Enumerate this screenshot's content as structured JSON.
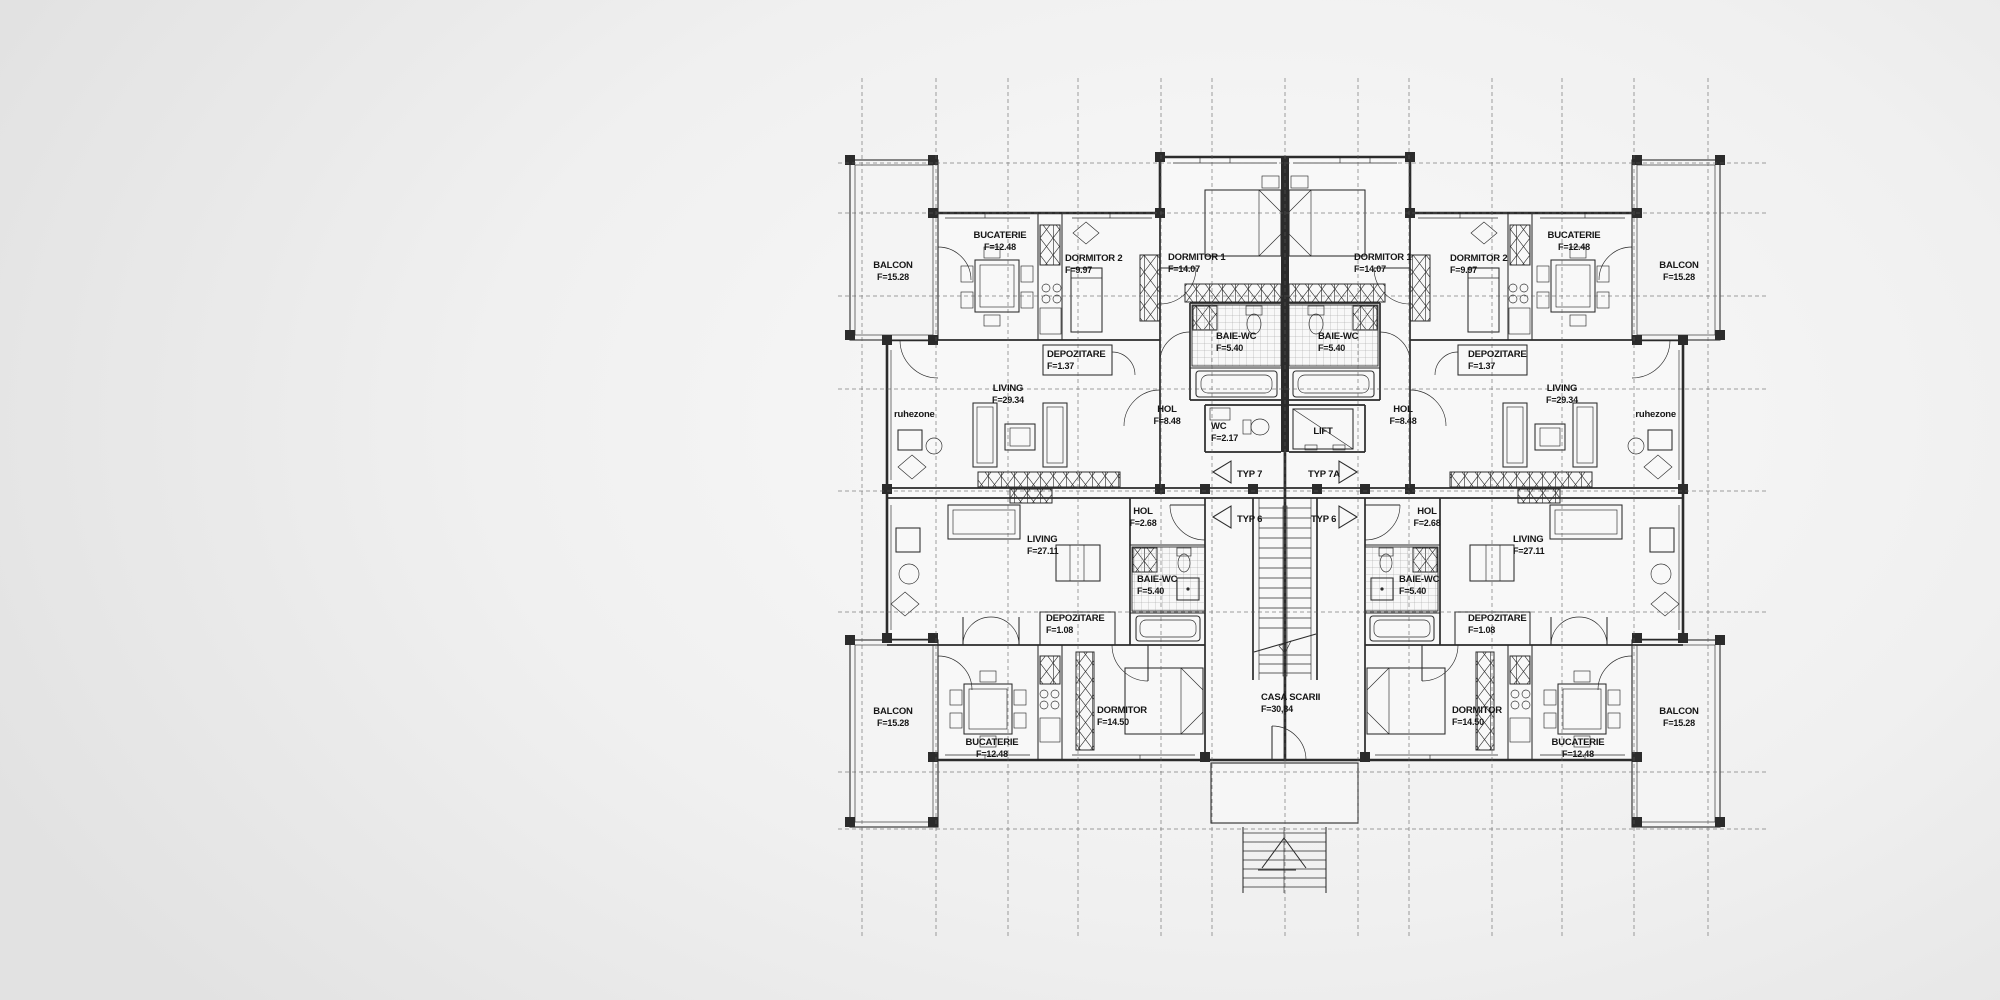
{
  "colors": {
    "bg_outer": "#e2e2e2",
    "bg_inner": "#fafafa",
    "ink": "#2b2b2b",
    "grid": "#5a5a5a",
    "room_fill": "#f8f8f8",
    "balcony_fill": "#f4f4f4"
  },
  "plan": {
    "grid": {
      "vertical": [
        862,
        936,
        1008,
        1078,
        1161,
        1212,
        1285,
        1358,
        1409,
        1492,
        1562,
        1634,
        1708
      ],
      "vertical_extent": [
        78,
        938
      ],
      "horizontal": [
        163,
        213,
        296,
        389,
        491,
        612,
        772,
        829
      ],
      "horizontal_extent": [
        838,
        1768
      ]
    },
    "labels": [
      {
        "id": "balcon-tl",
        "text": "BALCON",
        "sub": "F=15.28",
        "x": 893,
        "y": 268,
        "anchor": "middle"
      },
      {
        "id": "bucaterie-tl",
        "text": "BUCATERIE",
        "sub": "F=12.48",
        "x": 1000,
        "y": 238,
        "anchor": "middle"
      },
      {
        "id": "dormitor2-tl",
        "text": "DORMITOR 2",
        "sub": "F=9.97",
        "x": 1065,
        "y": 261,
        "anchor": "start"
      },
      {
        "id": "dormitor1-tl",
        "text": "DORMITOR 1",
        "sub": "F=14.07",
        "x": 1168,
        "y": 260,
        "anchor": "start"
      },
      {
        "id": "baie-wc-tl",
        "text": "BAIE-WC",
        "sub": "F=5.40",
        "x": 1216,
        "y": 339,
        "anchor": "start"
      },
      {
        "id": "depozitare-tl",
        "text": "DEPOZITARE",
        "sub": "F=1.37",
        "x": 1047,
        "y": 357,
        "anchor": "start"
      },
      {
        "id": "living-tl",
        "text": "LIVING",
        "sub": "F=29.34",
        "x": 1008,
        "y": 391,
        "anchor": "middle"
      },
      {
        "id": "ruhezone-l",
        "text": "ruhezone",
        "x": 894,
        "y": 417,
        "anchor": "start"
      },
      {
        "id": "hol-tl",
        "text": "HOL",
        "sub": "F=8.48",
        "x": 1167,
        "y": 412,
        "anchor": "middle"
      },
      {
        "id": "wc",
        "text": "WC",
        "sub": "F=2.17",
        "x": 1211,
        "y": 429,
        "anchor": "start"
      },
      {
        "id": "lift",
        "text": "LIFT",
        "x": 1323,
        "y": 434,
        "anchor": "middle"
      },
      {
        "id": "typ7",
        "text": "TYP 7",
        "x": 1237,
        "y": 477,
        "anchor": "start"
      },
      {
        "id": "typ7a",
        "text": "TYP 7A",
        "x": 1308,
        "y": 477,
        "anchor": "start"
      },
      {
        "id": "typ6-l",
        "text": "TYP 6",
        "x": 1237,
        "y": 522,
        "anchor": "start"
      },
      {
        "id": "typ6-r",
        "text": "TYP 6",
        "x": 1311,
        "y": 522,
        "anchor": "start"
      },
      {
        "id": "hol-bl",
        "text": "HOL",
        "sub": "F=2.68",
        "x": 1143,
        "y": 514,
        "anchor": "middle"
      },
      {
        "id": "living-bl",
        "text": "LIVING",
        "sub": "F=27.11",
        "x": 1027,
        "y": 542,
        "anchor": "start"
      },
      {
        "id": "baie-wc-bl",
        "text": "BAIE-WC",
        "sub": "F=5.40",
        "x": 1137,
        "y": 582,
        "anchor": "start"
      },
      {
        "id": "depozitare-bl",
        "text": "DEPOZITARE",
        "sub": "F=1.08",
        "x": 1046,
        "y": 621,
        "anchor": "start"
      },
      {
        "id": "dormitor-bl",
        "text": "DORMITOR",
        "sub": "F=14.50",
        "x": 1097,
        "y": 713,
        "anchor": "start"
      },
      {
        "id": "casa-scarii",
        "text": "CASA SCARII",
        "sub": "F=30,84",
        "x": 1261,
        "y": 700,
        "anchor": "start"
      },
      {
        "id": "bucaterie-bl",
        "text": "BUCATERIE",
        "sub": "F=12.48",
        "x": 992,
        "y": 745,
        "anchor": "middle"
      },
      {
        "id": "balcon-bl",
        "text": "BALCON",
        "sub": "F=15.28",
        "x": 893,
        "y": 714,
        "anchor": "middle"
      },
      {
        "id": "dormitor1-tr",
        "text": "DORMITOR 1",
        "sub": "F=14.07",
        "x": 1354,
        "y": 260,
        "anchor": "start"
      },
      {
        "id": "baie-wc-tr",
        "text": "BAIE-WC",
        "sub": "F=5.40",
        "x": 1318,
        "y": 339,
        "anchor": "start"
      },
      {
        "id": "dormitor2-tr",
        "text": "DORMITOR 2",
        "sub": "F=9.97",
        "x": 1450,
        "y": 261,
        "anchor": "start"
      },
      {
        "id": "depozitare-tr",
        "text": "DEPOZITARE",
        "sub": "F=1.37",
        "x": 1468,
        "y": 357,
        "anchor": "start"
      },
      {
        "id": "bucaterie-tr",
        "text": "BUCATERIE",
        "sub": "F=12.48",
        "x": 1574,
        "y": 238,
        "anchor": "middle"
      },
      {
        "id": "balcon-tr",
        "text": "BALCON",
        "sub": "F=15.28",
        "x": 1679,
        "y": 268,
        "anchor": "middle"
      },
      {
        "id": "living-tr",
        "text": "LIVING",
        "sub": "F=29.34",
        "x": 1562,
        "y": 391,
        "anchor": "middle"
      },
      {
        "id": "ruhezone-r",
        "text": "ruhezone",
        "x": 1676,
        "y": 417,
        "anchor": "end"
      },
      {
        "id": "hol-tr",
        "text": "HOL",
        "sub": "F=8.48",
        "x": 1403,
        "y": 412,
        "anchor": "middle"
      },
      {
        "id": "hol-br",
        "text": "HOL",
        "sub": "F=2.68",
        "x": 1427,
        "y": 514,
        "anchor": "middle"
      },
      {
        "id": "baie-wc-br",
        "text": "BAIE-WC",
        "sub": "F=5.40",
        "x": 1399,
        "y": 582,
        "anchor": "start"
      },
      {
        "id": "living-br",
        "text": "LIVING",
        "sub": "F=27.11",
        "x": 1513,
        "y": 542,
        "anchor": "start"
      },
      {
        "id": "depozitare-br",
        "text": "DEPOZITARE",
        "sub": "F=1.08",
        "x": 1468,
        "y": 621,
        "anchor": "start"
      },
      {
        "id": "dormitor-br",
        "text": "DORMITOR",
        "sub": "F=14.50",
        "x": 1452,
        "y": 713,
        "anchor": "start"
      },
      {
        "id": "bucaterie-br",
        "text": "BUCATERIE",
        "sub": "F=12.48",
        "x": 1578,
        "y": 745,
        "anchor": "middle"
      },
      {
        "id": "balcon-br",
        "text": "BALCON",
        "sub": "F=15.28",
        "x": 1679,
        "y": 714,
        "anchor": "middle"
      }
    ]
  }
}
